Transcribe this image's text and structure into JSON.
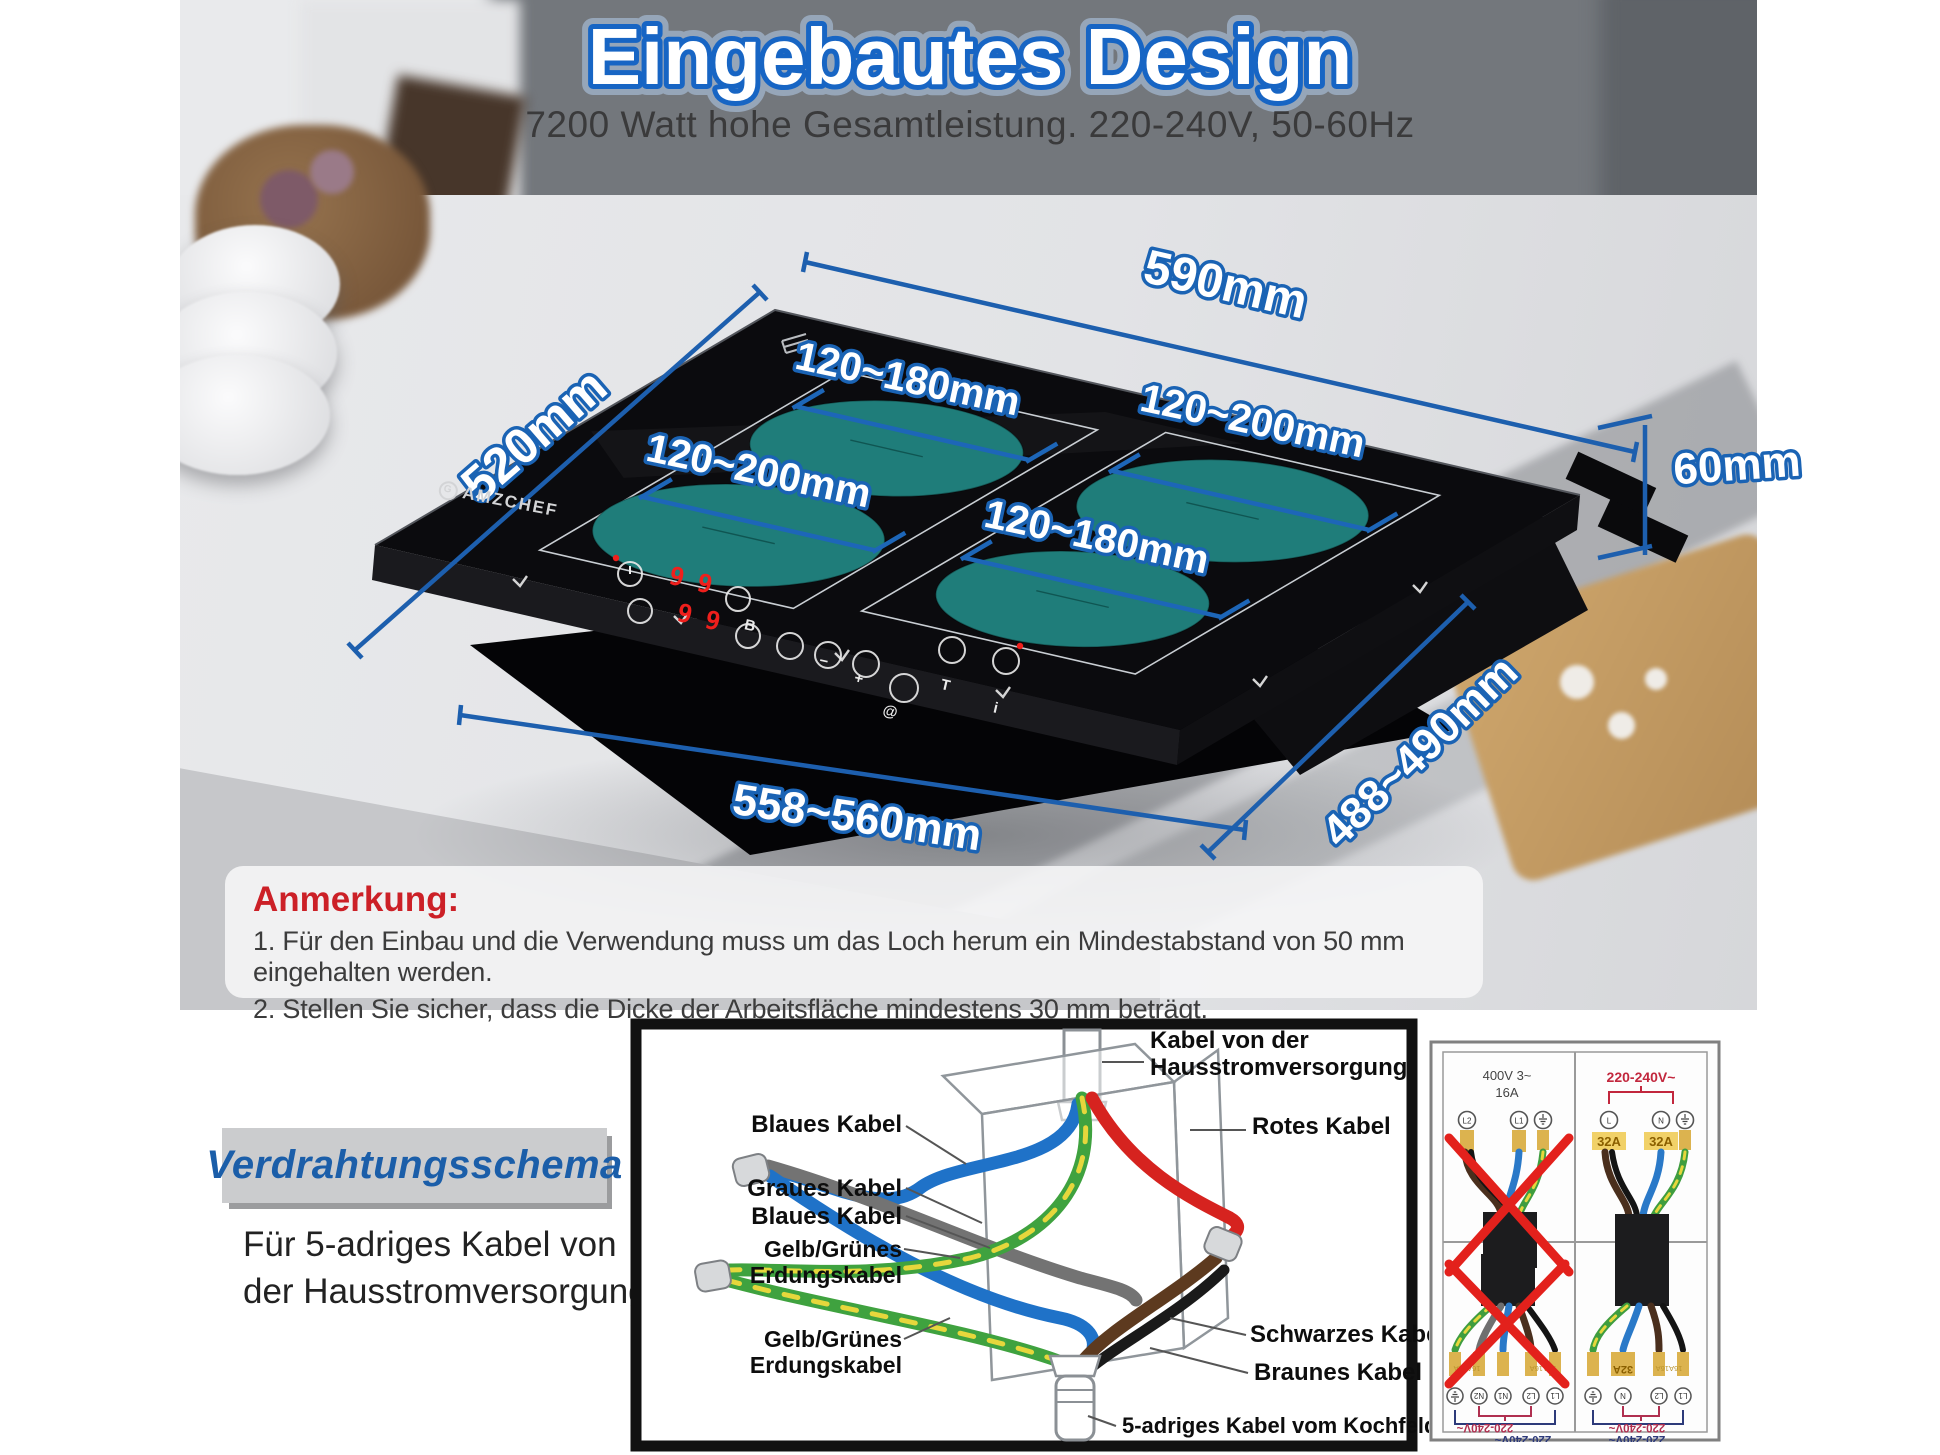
{
  "header": {
    "title": "Eingebautes Design",
    "subtitle": "7200 Watt hohe Gesamtleistung. 220-240V, 50-60Hz"
  },
  "cooktop": {
    "brand": "AMZCHEF",
    "digits": [
      "9",
      "9",
      "9",
      "9"
    ]
  },
  "dimensions": {
    "top_width": "590mm",
    "left_depth": "520mm",
    "height": "60mm",
    "cutout_width": "558~560mm",
    "cutout_depth": "488~490mm",
    "zone_top_left": "120~180mm",
    "zone_mid_left": "120~200mm",
    "zone_top_right": "120~200mm",
    "zone_bottom_right": "120~180mm"
  },
  "note": {
    "heading": "Anmerkung:",
    "items": [
      "1. Für den Einbau und die Verwendung muss um das Loch herum ein Mindestabstand von 50 mm eingehalten werden.",
      "2. Stellen Sie sicher, dass die Dicke der Arbeitsfläche mindestens 30 mm beträgt."
    ]
  },
  "wiring": {
    "badge": "Verdrahtungsschema",
    "desc_line1": "Für 5-adriges Kabel von",
    "desc_line2": "der Hausstromversorgung",
    "labels": {
      "supply": "Kabel von der Hausstromversorgung",
      "blaues1": "Blaues Kabel",
      "rotes": "Rotes Kabel",
      "graues": "Graues Kabel",
      "blaues2": "Blaues Kabel",
      "gelb1": "Gelb/Grünes Erdungskabel",
      "gelb2": "Gelb/Grünes Erdungskabel",
      "schwarzes": "Schwarzes Kabel",
      "braunes": "Braunes Kabel",
      "kochfeld": "5-adriges Kabel vom Kochfeld"
    },
    "chart": {
      "q1": {
        "t1": "400V 3~",
        "t2": "16A",
        "term1": "L2",
        "term2": "L1"
      },
      "q2": {
        "title": "220-240V~",
        "f1": "32A",
        "f2": "32A",
        "term1": "L",
        "term2": "N"
      },
      "q3": {
        "f1": "16A16A",
        "f2": "16A16A",
        "v1": "220-240V~",
        "v2": "220-240V~",
        "t1": "N2",
        "t2": "N1",
        "t3": "L2",
        "t4": "L1"
      },
      "q4": {
        "f1": "32A",
        "f2": "16A16A",
        "v1": "220-240V~",
        "v2": "220-240V~",
        "t1": "N",
        "t2": "L2",
        "t3": "L1"
      }
    }
  },
  "colors": {
    "accent_blue": "#1a66b8",
    "dimension_line": "#1d5fae",
    "zone_teal": "#1f7d7a",
    "note_red": "#cc2027",
    "cross_red": "#e3211c",
    "badge_blue": "#1b5ea9",
    "wire_blue": "#1f72c8",
    "wire_red": "#d6231f",
    "wire_green": "#3fa23f",
    "wire_yellow": "#e6d73c",
    "wire_brown": "#5d3a1f",
    "wire_gray": "#737373",
    "wire_black": "#1a1a1a"
  }
}
